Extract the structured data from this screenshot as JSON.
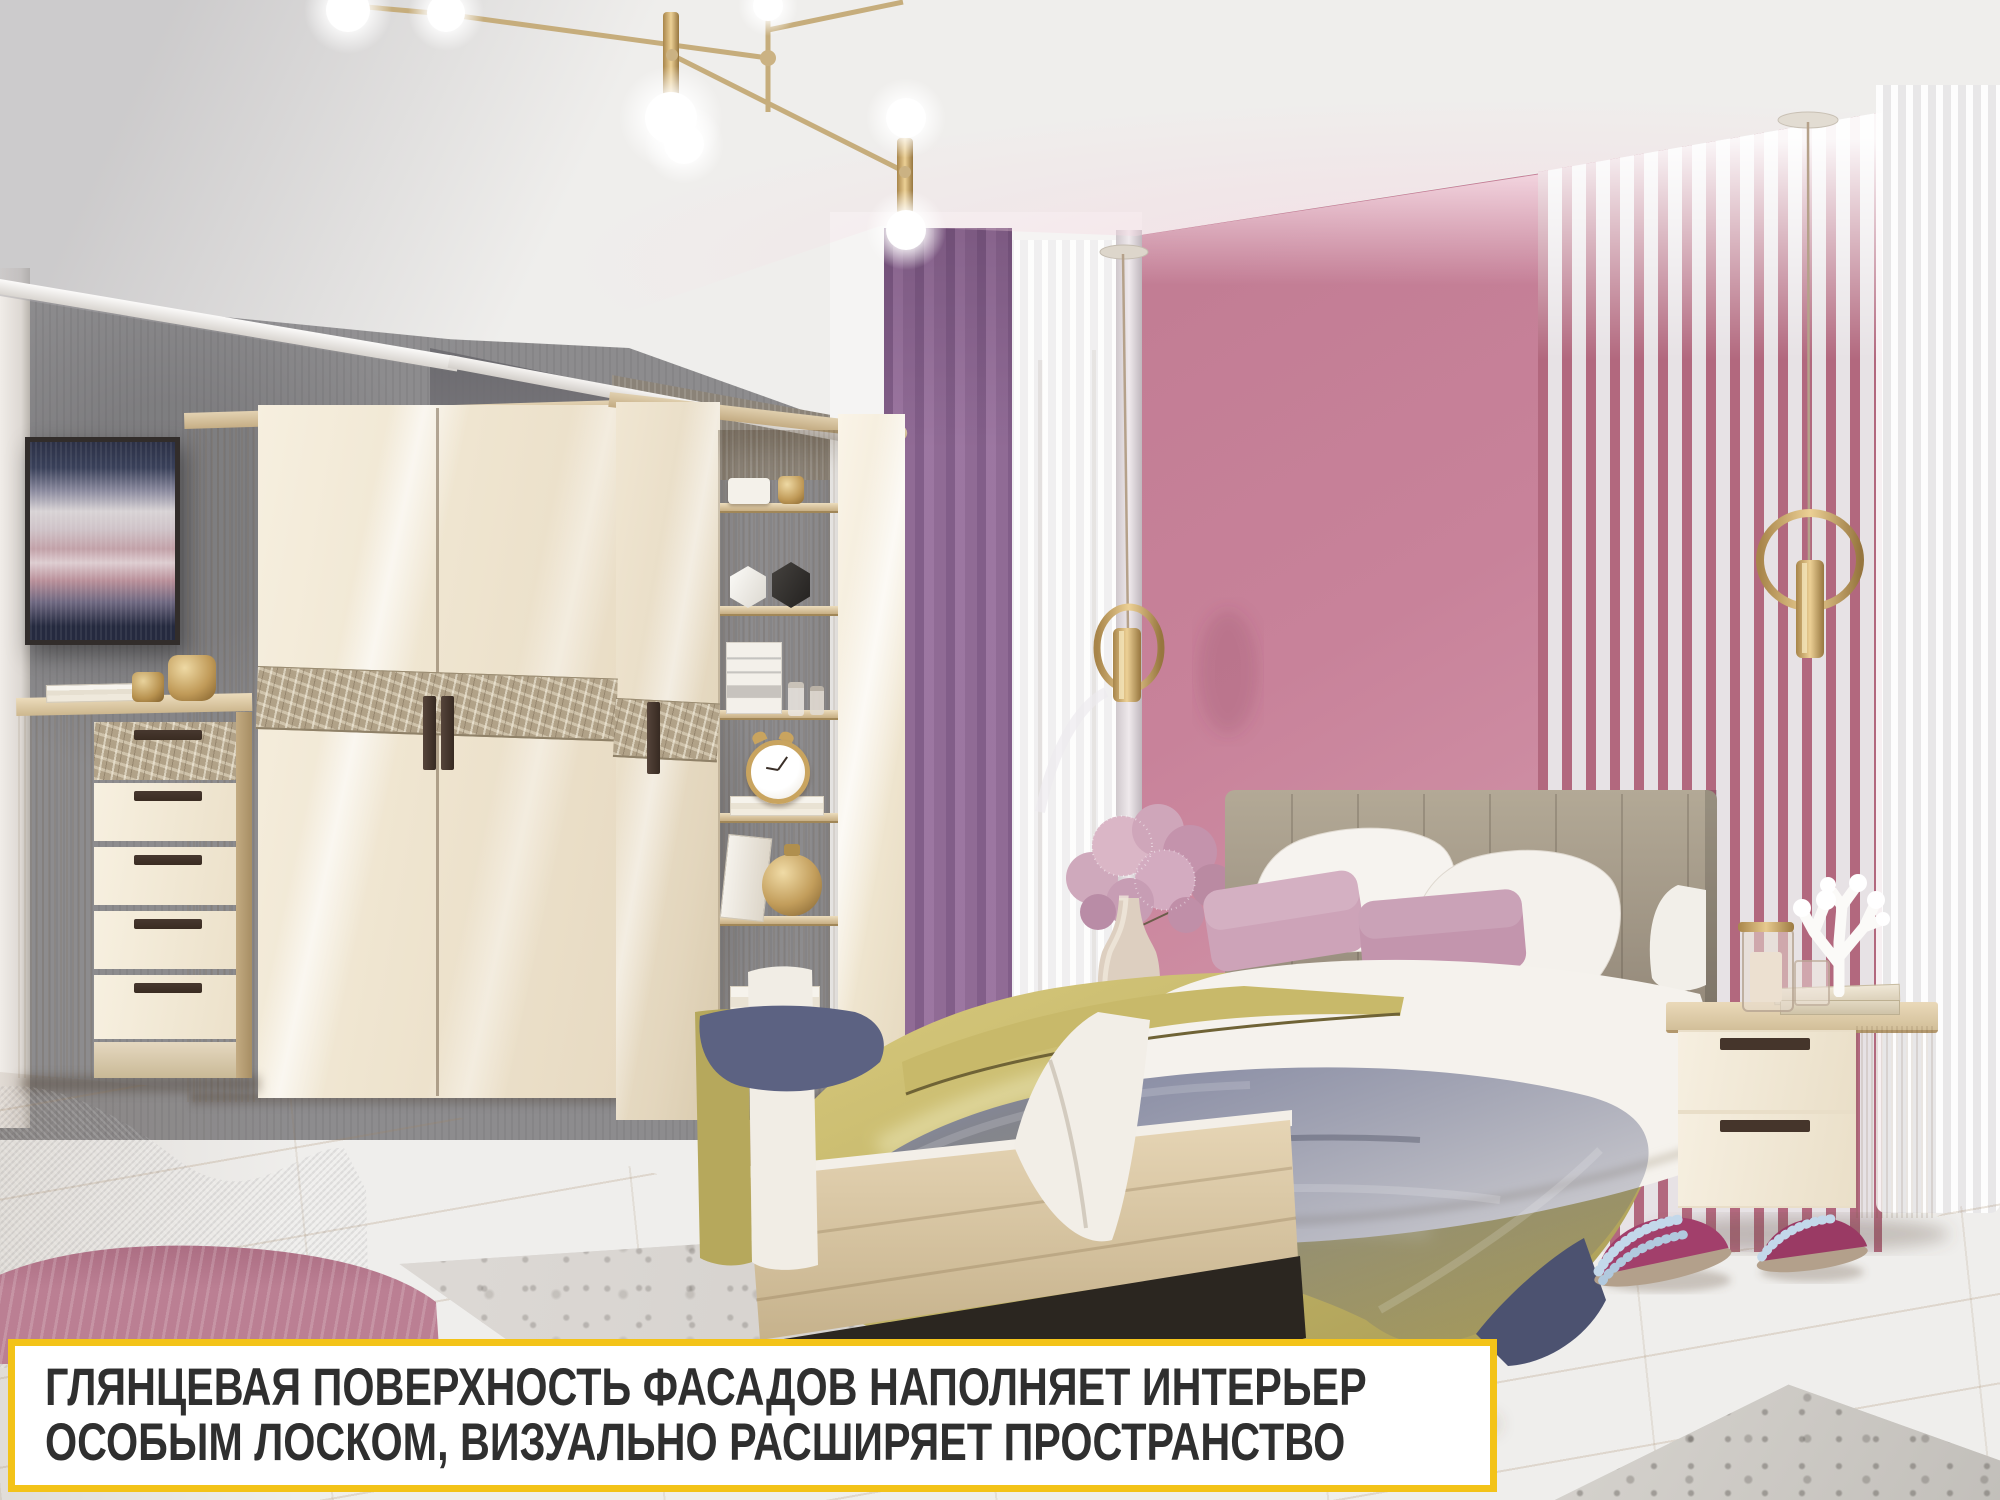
{
  "meta": {
    "kind": "furniture-showroom-photo",
    "room": "bedroom"
  },
  "caption": {
    "line1": "ГЛЯНЦЕВАЯ ПОВЕРХНОСТЬ ФАСАДОВ НАПОЛНЯЕТ ИНТЕРЬЕР",
    "line2": "ОСОБЫМ ЛОСКОМ, ВИЗУАЛЬНО РАСШИРЯЕТ ПРОСТРАНСТВО",
    "border_color": "#F3C318",
    "background": "#FFFFFF",
    "text_color": "#2F2F2F"
  },
  "palette": {
    "ceiling": "#EFEDED",
    "left_wall_gray": "#8D8C8E",
    "accent_wall_pink": "#C8829A",
    "stripe_pink": "#B2687E",
    "stripe_silver": "#E7E2E5",
    "furniture_gloss_cream": "#F4EBDA",
    "furniture_wood_oak": "#D3BF9E",
    "decor_band_taupe": "#B1A288",
    "handle_brown": "#45352B",
    "floor_wood": "#ECDFCA",
    "rug_gray": "#D8D5D1",
    "bedspread_olive": "#C2B467",
    "throw_blue_gray": "#666C88",
    "pillow_pink": "#C795AB",
    "headboard_taupe": "#A79D8F",
    "curtain_lavender": "#C2A8C5",
    "gold_metal": "#C7A96E",
    "slipper_magenta": "#9E3A68",
    "slipper_fur_blue": "#BFD6EA"
  },
  "objects": [
    "sputnik-chandelier",
    "gold-ring-pendant-light-left",
    "gold-ring-pendant-light-right",
    "abstract-wall-art",
    "corner-wardrobe-glossy-cream",
    "decorative-pattern-band",
    "open-corner-shelf-unit",
    "alarm-clock",
    "gold-vase",
    "chest-of-drawers-five",
    "double-bed-oak-frame",
    "upholstered-channel-headboard",
    "white-pillows",
    "pink-cushions",
    "olive-satin-bedspread",
    "blue-velvet-throw",
    "flower-vase-pink-pompoms",
    "nightstand-two-drawers",
    "white-coral-decor",
    "candle-jar",
    "books",
    "lavender-curtain",
    "sheer-curtain-left",
    "sheer-curtain-right",
    "pink-accent-wall",
    "striped-accent-wall",
    "gray-concrete-wall",
    "light-wood-floor",
    "gray-washed-rug",
    "gray-armchair",
    "pink-blanket",
    "pink-slippers"
  ]
}
